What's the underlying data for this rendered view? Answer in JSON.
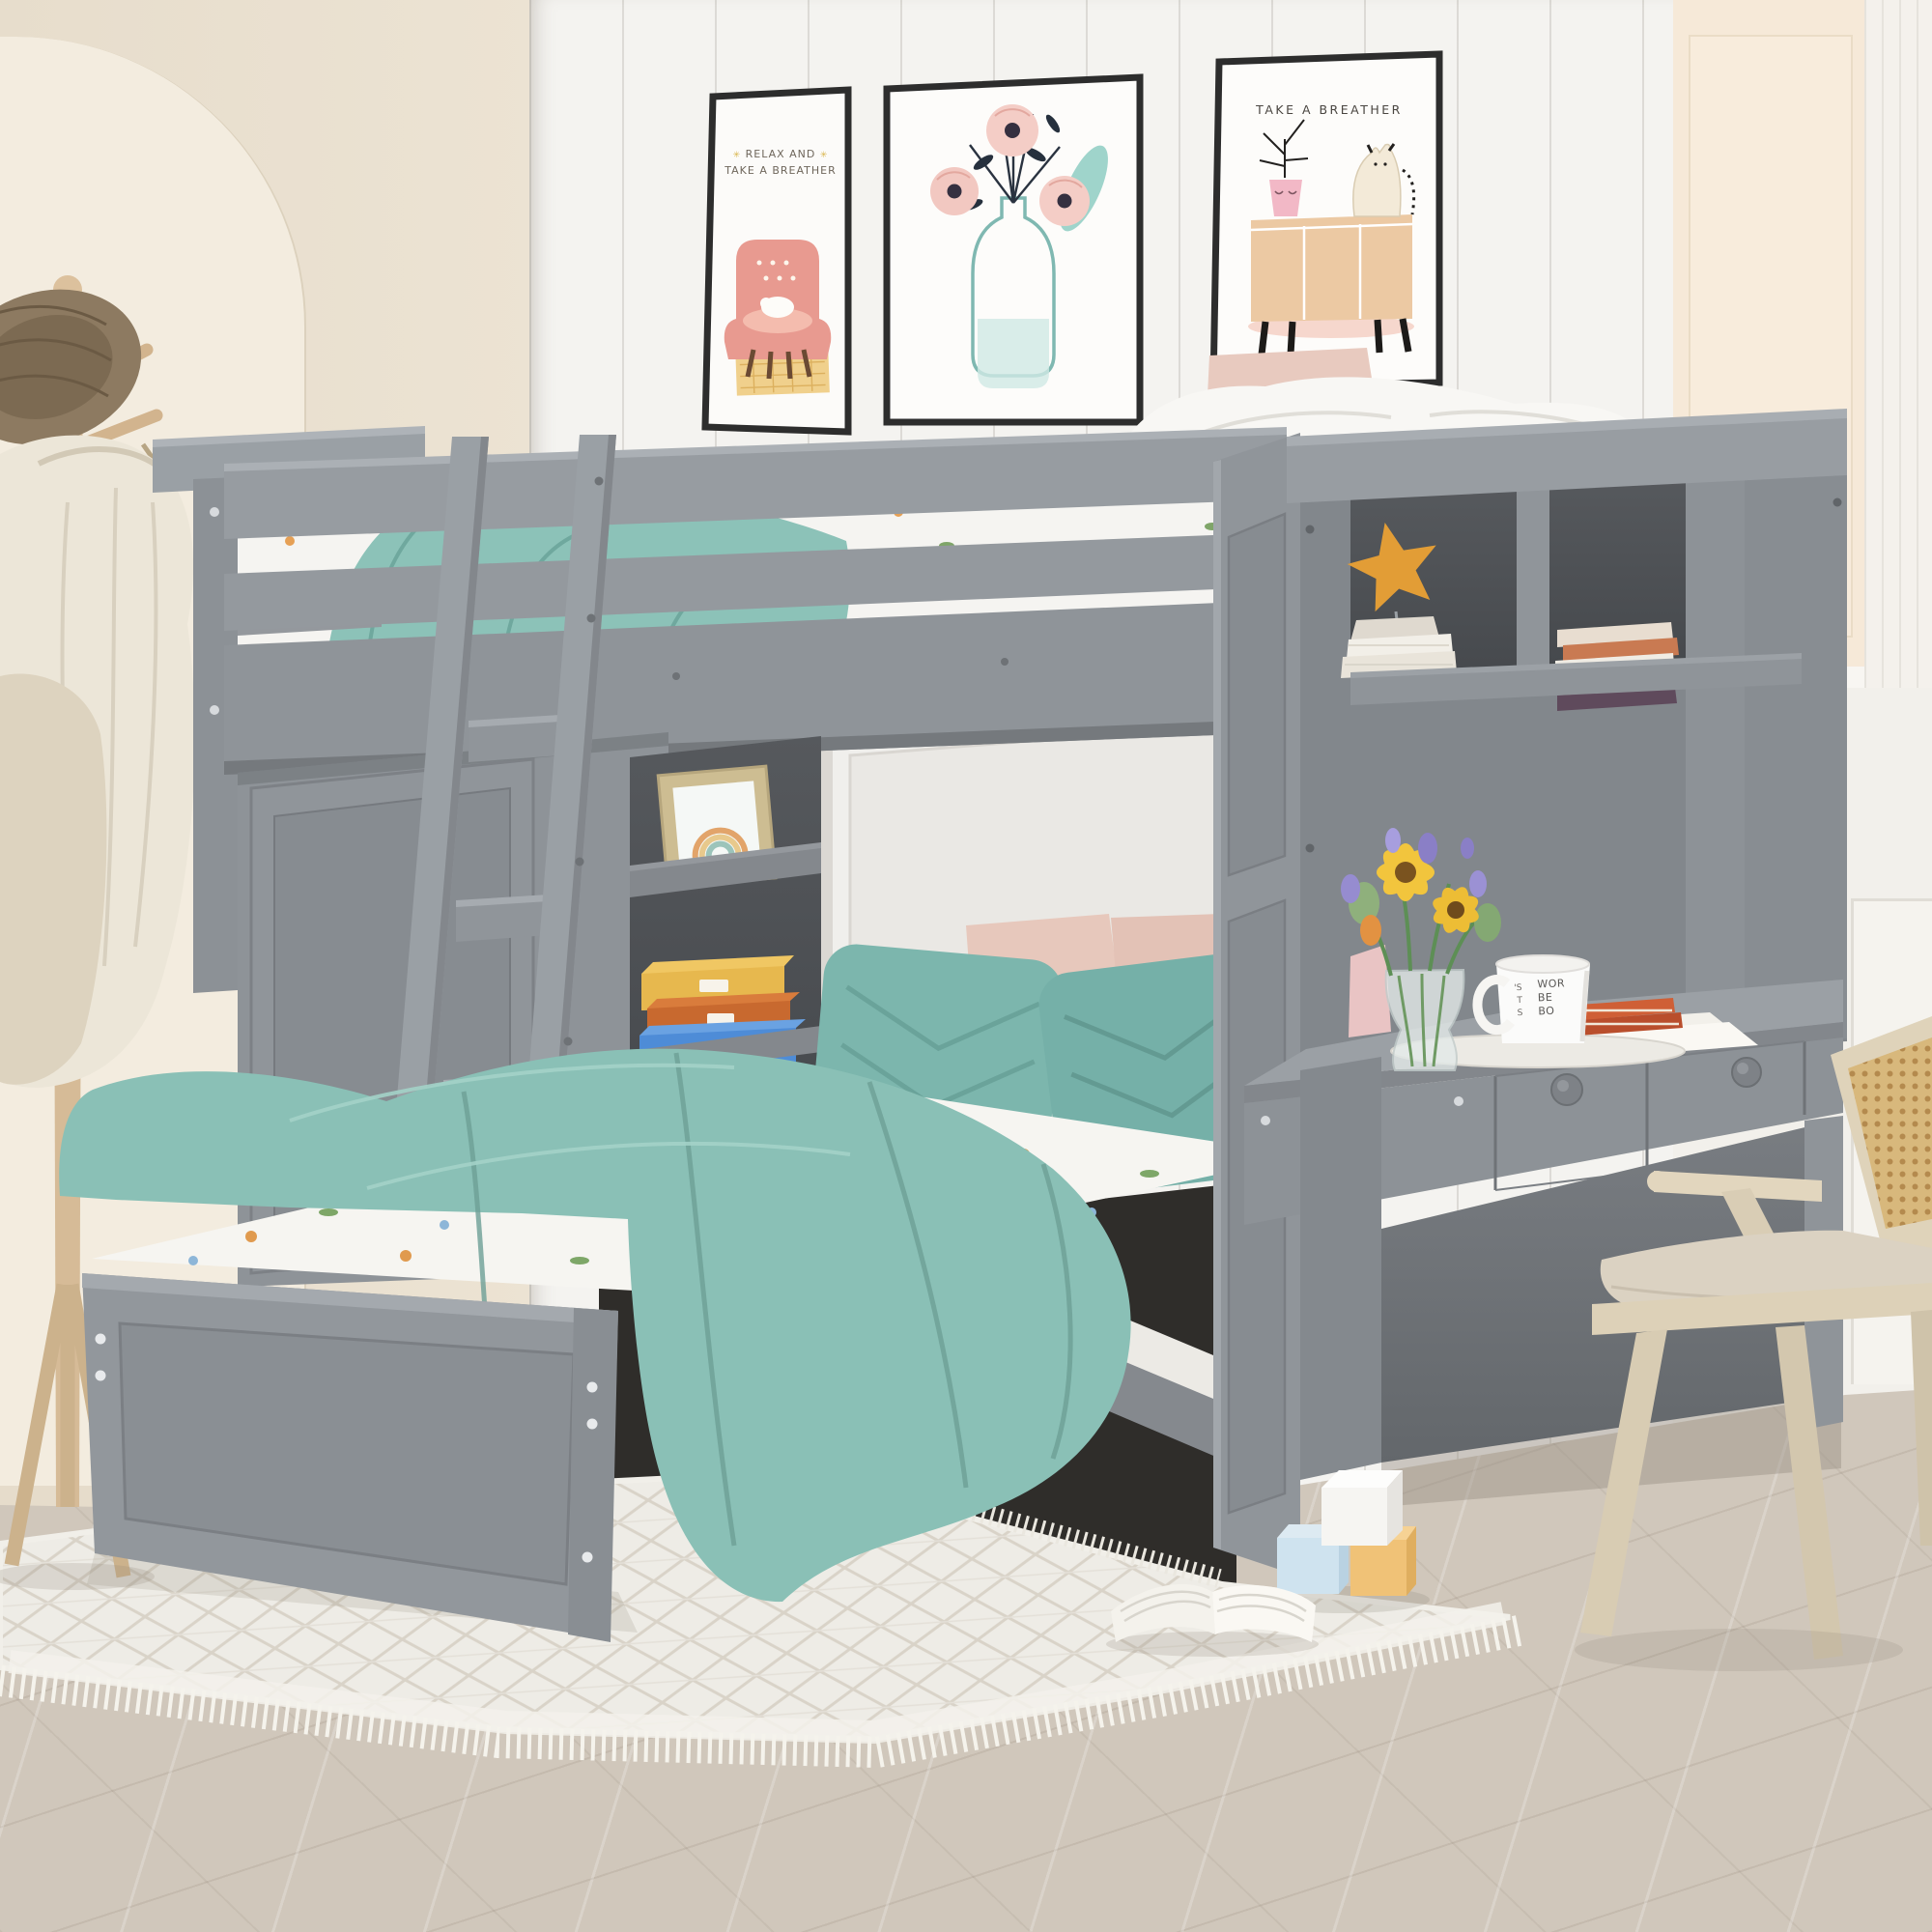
{
  "meta": {
    "title": "Grey twin-over-full loft bed with wardrobe, shelves, desk and hutch",
    "scene_type": "staged kids-bedroom furniture product photograph"
  },
  "posters": {
    "items": [
      {
        "id": "poster-armchair",
        "caption_lines": [
          "RELAX AND",
          "TAKE A BREATHER"
        ],
        "star_glyph": "✳",
        "art": "pink armchair with sleeping white cat on a yellow checked rug"
      },
      {
        "id": "poster-flowers",
        "caption_lines": [],
        "art": "three pink anemone flowers with dark sprigs and teal leaves in a glass bottle vase"
      },
      {
        "id": "poster-cabinet-cat",
        "caption_lines": [
          "TAKE A BREATHER"
        ],
        "art": "cream cat and pink planter with closed eyes sitting on a tan sideboard"
      }
    ]
  },
  "mug": {
    "full_text": "WORLD'S BEST BOSS",
    "left_fragments": [
      "'S",
      "T",
      "S"
    ],
    "right_fragments": [
      "WOR",
      "BE",
      "BO"
    ]
  },
  "furniture": {
    "loft_bed": "grey wood twin loft bed with guard rails and front ladder",
    "wardrobe": "grey single-door wardrobe under the loft bed, left side",
    "open_shelves": "dark recessed shelf niche holding a gold-framed rainbow print and three storage boxes (yellow, orange, blue) with blank white labels",
    "lower_bed": "perpendicular platform bed with grey panel footboard, white cactus/flower print sheets, two teal quilted pillows, two blush pillows and a draped teal quilt",
    "desk": "grey writing desk with two drawers and round knobs",
    "hutch": "grey hutch with two cubbies: orange starfish ornament on white books (left), stack of five books in cream, terracotta, white and plum (right)",
    "desk_items": "glass vase with yellow sunflowers, purple and orange tulips; white mug; white tray; papers; two orange books; pink gift bag",
    "chair": "light-wood chair with rattan cane back, beige cushion and splayed V legs",
    "coat_rack": "natural wood coat stand with wicker hat and cream coat/towel"
  },
  "floor_items": {
    "toy_blocks": [
      "white",
      "light-blue",
      "orange"
    ],
    "open_book": "open book lying on the rug"
  },
  "palette": {
    "furniture_grey": "#8f9499",
    "furniture_grey_light": "#9da2a7",
    "furniture_grey_dark": "#7b7f84",
    "alcove_dark": "#53565a",
    "teal_quilt": "#8ac0b6",
    "teal_pillow": "#79b3ab",
    "blush_pillow": "#e7c8bc",
    "white_bedding": "#f6f5f1",
    "wall_cream": "#ebe2d2",
    "wall_peach": "#f6e9d8",
    "wall_panel_white": "#f4f3f0",
    "floor_wood": "#d0c7bb",
    "rug_white": "#eeece6",
    "box_yellow": "#e7b84e",
    "box_orange": "#c8692f",
    "box_blue": "#4e8cd7",
    "starfish_orange": "#e29d36",
    "chair_wood": "#ddd2ba",
    "chair_cane": "#d8b87c",
    "poster_frame": "#2d2d2d",
    "sunflower": "#f2c53d",
    "flower_purple": "#968cd0",
    "book_orange": "#cf5f36"
  }
}
